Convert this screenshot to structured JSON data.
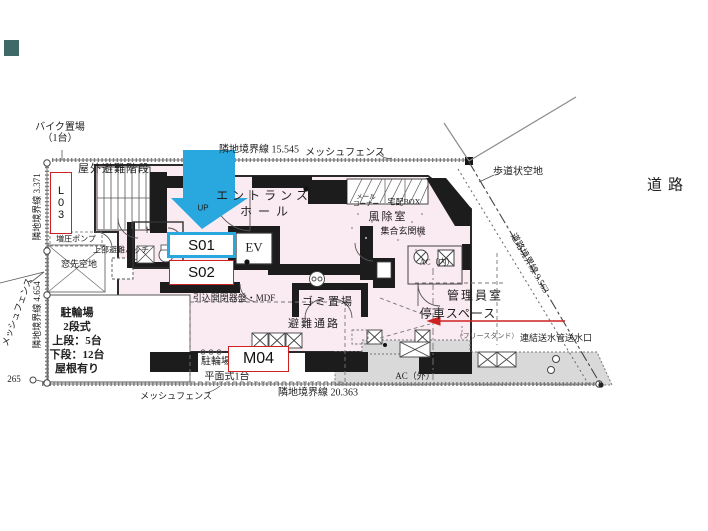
{
  "plan": {
    "colors": {
      "arrow_blue": "#29a8e0",
      "tag_red": "#cc2222",
      "floor_pink": "#faeaf1",
      "pavement_gray": "#d9d9d9",
      "wall_black": "#1c1c1c"
    },
    "unit_tags": {
      "l03": "L03",
      "s01": "S01",
      "s02": "S02",
      "m04": "M04"
    },
    "labels": {
      "bike_area_1": "バイク置場",
      "bike_area_2": "（1台）",
      "outdoor_stairs": "屋外避難階段",
      "boundary_left_top": "隣地境界線 3.371",
      "mesh_fence_left": "メッシュフェンス",
      "boundary_left_bottom": "隣地境界線 4.654",
      "dim_265": "265",
      "pump": "増圧ポンプ",
      "upper_hatch": "上部避難ハッチ",
      "window_space": "窓先空地",
      "bicycle_1": "駐輪場",
      "bicycle_2": "2段式",
      "bicycle_3": "上段：5台",
      "bicycle_4": "下段：12台",
      "bicycle_5": "屋根有り",
      "toilet": "トイレ",
      "up": "UP",
      "entrance_1": "エントランス",
      "entrance_2": "ホール",
      "ev": "EV",
      "mdf": "引込開閉器盤・MDF",
      "garbage": "ゴミ置場",
      "evac_route": "避難通路",
      "mail_1": "メール",
      "mail_2": "コーナー",
      "delivery_box": "宅配BOX",
      "windbreak": "風除室",
      "entrance_unit": "集合玄関機",
      "ac_in": "AC（内）",
      "manager_room": "管理員室",
      "stop_space": "停車スペース",
      "standpipe_prefix": "（フリースタンド）",
      "standpipe": "連結送水管送水口",
      "sidewalk_space": "歩道状空地",
      "road": "道路",
      "road_boundary": "道路境界線 9.563",
      "boundary_top": "隣地境界線 15.545",
      "mesh_fence_top": "メッシュフェンス",
      "boundary_bottom": "隣地境界線 20.363",
      "mesh_fence_bottom": "メッシュフェンス",
      "ac_out": "AC（外）",
      "bike_flat_1": "駐輪場",
      "bike_flat_2": "平面式1台"
    }
  }
}
